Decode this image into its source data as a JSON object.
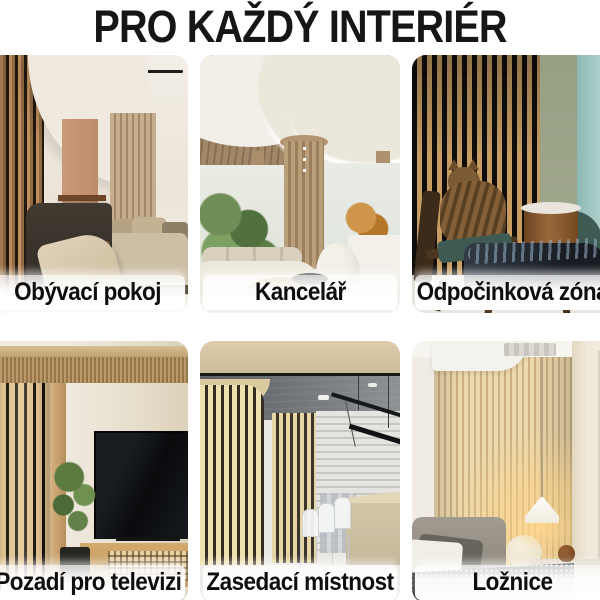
{
  "title": "PRO KAŽDÝ INTERIÉR",
  "palette": {
    "background": "#ffffff",
    "title_text": "#161616",
    "label_text": "#0e0e0e",
    "label_background": "#ffffff",
    "oak_slat": "#c79d62",
    "slat_gap_dark": "#14110d",
    "clay_accent": "#c89a78",
    "sage_wall": "#9aa287",
    "teal_wall": "#aecdc8"
  },
  "tiles": [
    {
      "id": "living-room",
      "label": "Obývací pokoj",
      "photo": "living-room-with-wood-slat-panels"
    },
    {
      "id": "office",
      "label": "Kancelář",
      "photo": "office-lobby-curved-led-ceiling"
    },
    {
      "id": "relax-zone",
      "label": "Odpočinková zóna",
      "photo": "lounge-chair-with-cat-slat-wall"
    },
    {
      "id": "tv-wall",
      "label": "Pozadí pro televizi",
      "photo": "tv-console-slat-wall"
    },
    {
      "id": "meeting-room",
      "label": "Zasedací místnost",
      "photo": "conference-room-slat-columns"
    },
    {
      "id": "bedroom",
      "label": "Ložnice",
      "photo": "bedroom-slat-headboard-pendant-lamp"
    }
  ]
}
